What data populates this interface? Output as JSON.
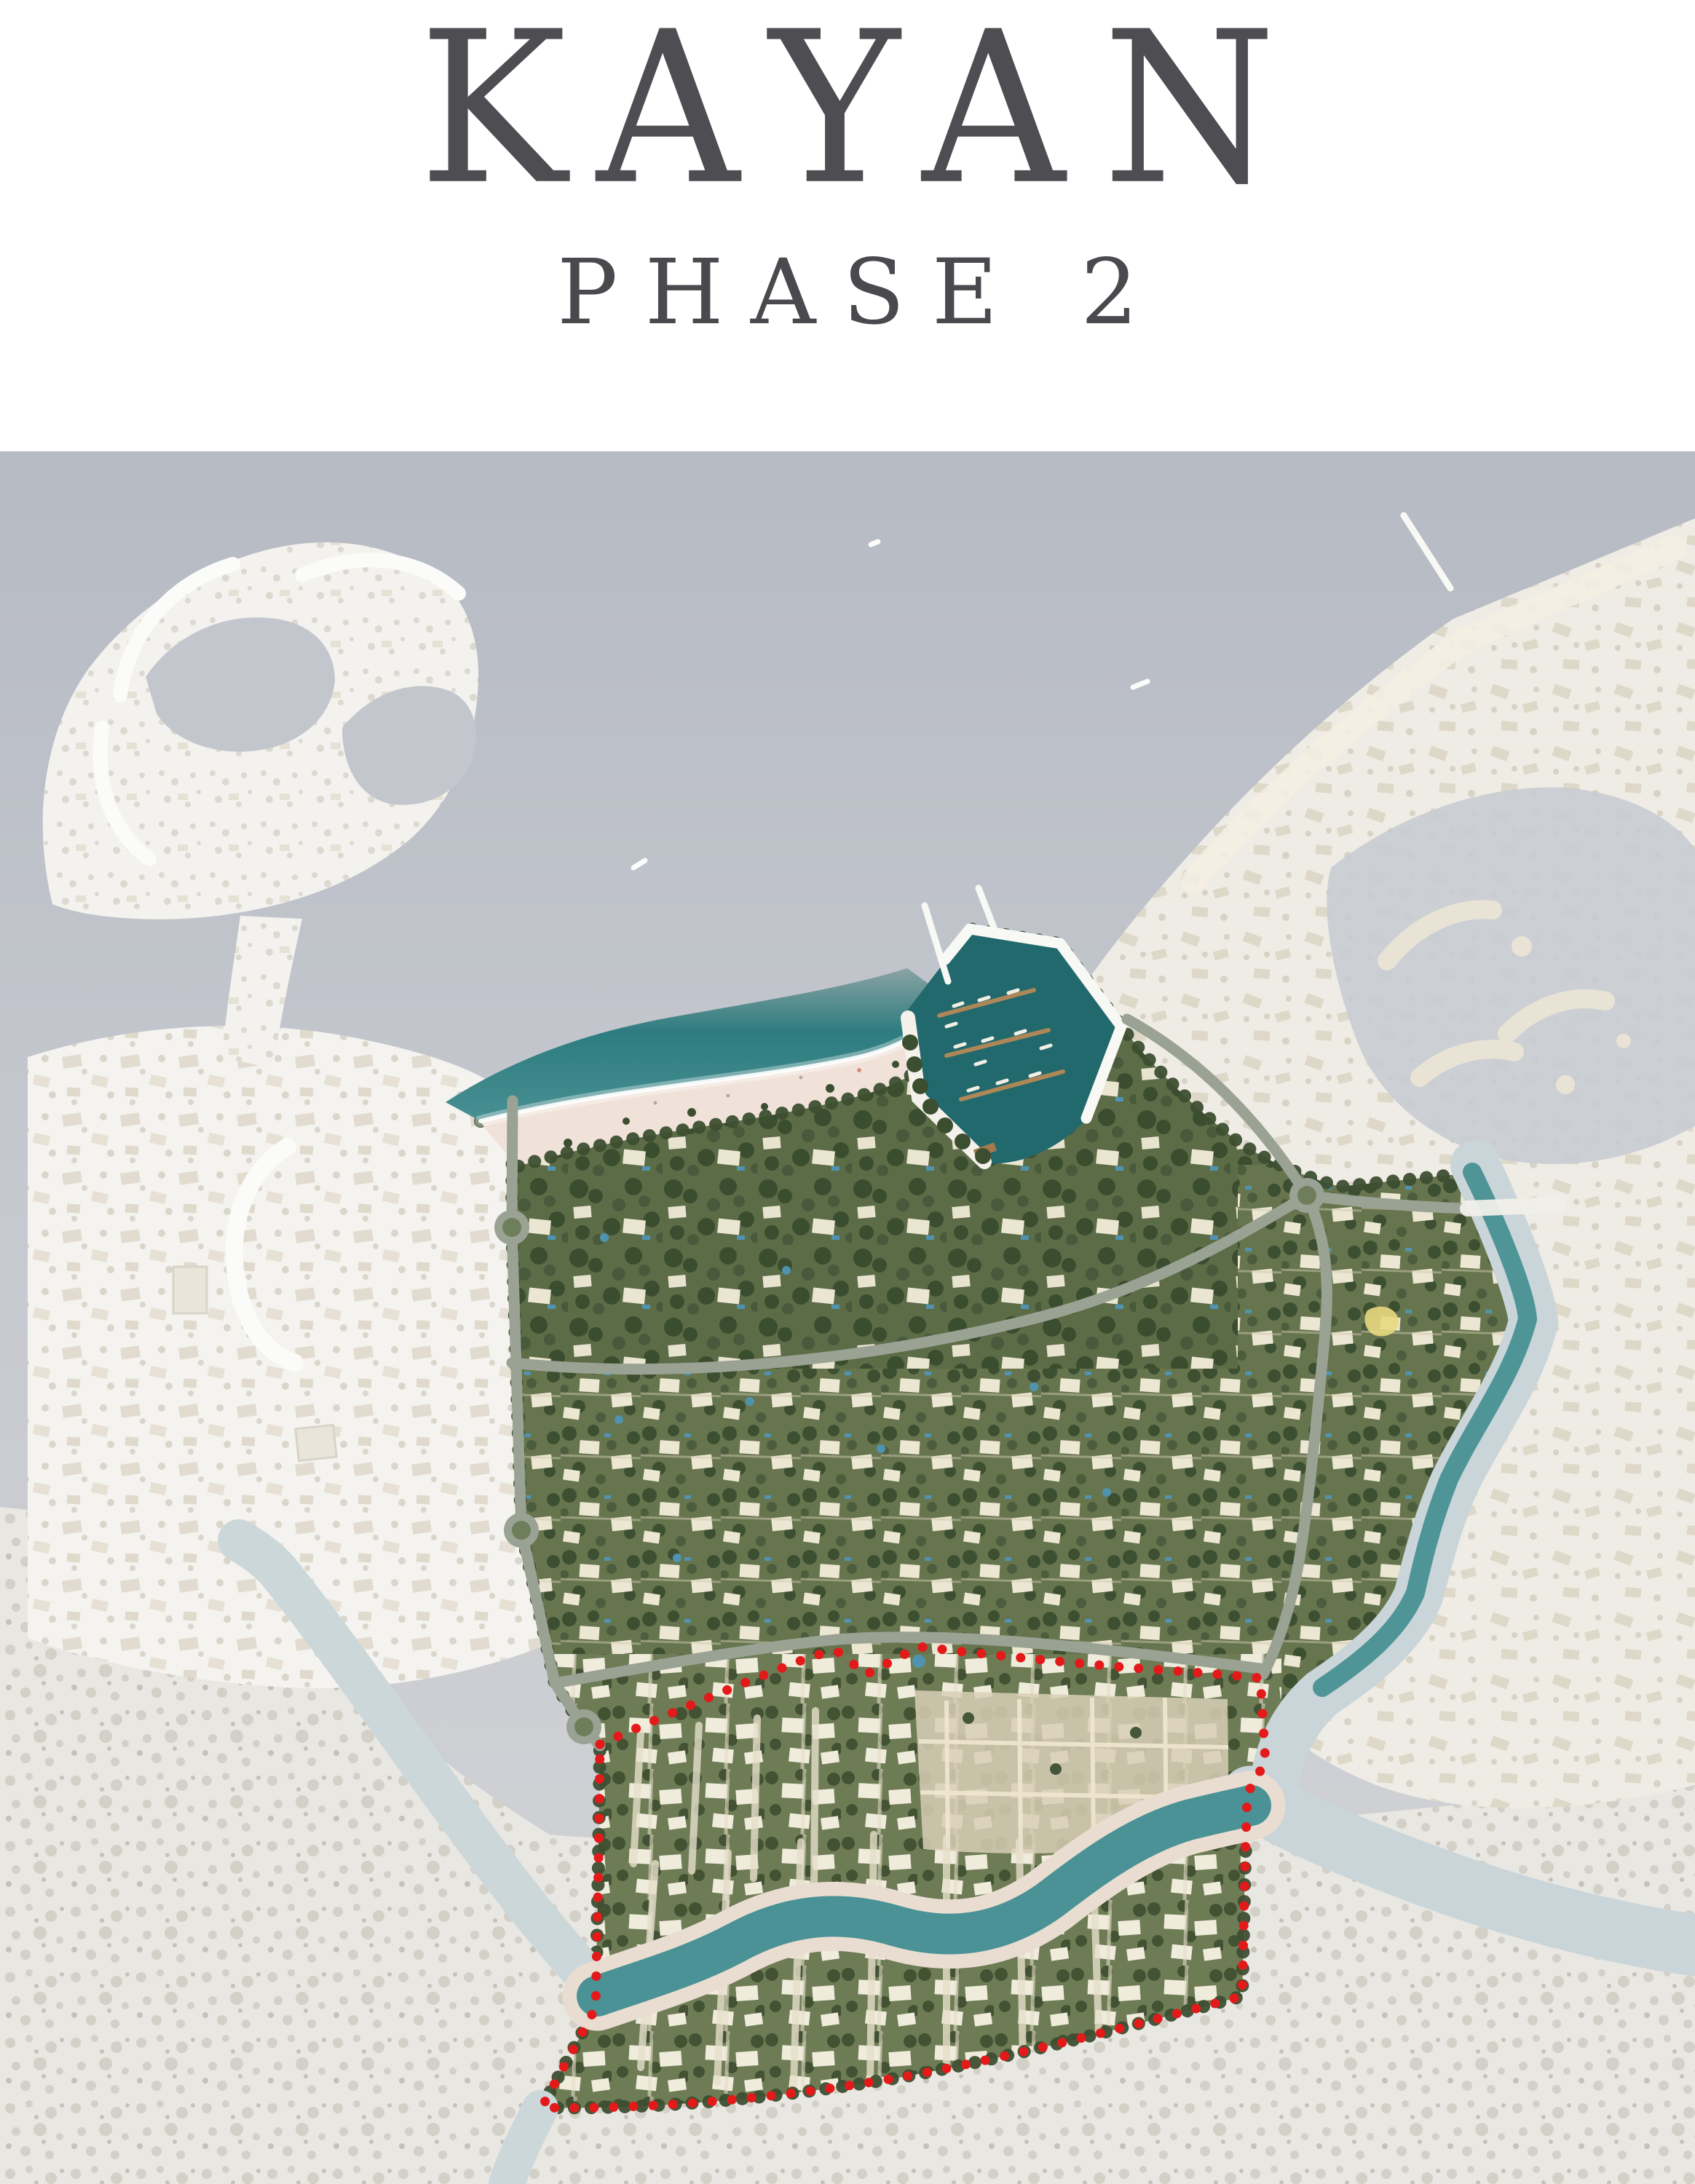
{
  "header": {
    "title": "KAYAN",
    "subtitle": "PHASE 2"
  },
  "map": {
    "type": "masterplan-aerial-rendering",
    "description": "Aerial masterplan of the Kayan coastal villa community; Phase 2 area outlined with a red dotted boundary in the southern districts around a winding waterway.",
    "regions": {
      "sea": {
        "name": "Sea",
        "color": "#bcc0c8"
      },
      "left_town": {
        "name": "Neighboring community west (faded)",
        "color": "#f4f3ef"
      },
      "crescent_community": {
        "name": "Crescent marina community north-west (faded)",
        "color": "#f3f2ee"
      },
      "right_community": {
        "name": "Neighboring lagoon community east (faded)",
        "color": "#efece5"
      },
      "outskirts": {
        "name": "Outskirts south (faded)",
        "color": "#e9e7e2"
      },
      "site": {
        "name": "Kayan villa community greenery",
        "color": "#5f6f4a"
      },
      "beach": {
        "name": "Beach",
        "color": "#f1e2d9"
      },
      "lagoon": {
        "name": "Lagoon",
        "color": "#2d7c7f"
      },
      "marina": {
        "name": "Marina basin with berthed boats",
        "color": "#21696c"
      },
      "east_canal": {
        "name": "East canal",
        "color": "#4f9598"
      },
      "river": {
        "name": "Winding waterway through Phase 2",
        "color": "#4a9295"
      },
      "phase2_boundary": {
        "name": "Phase 2 boundary",
        "color": "#e41a1a",
        "line_style": "dotted"
      }
    },
    "geometry": {
      "bottom_land": "M 0,2070 C 170,2085 310,2145 415,2245 C 515,2340 615,2435 755,2520 C 1180,2555 1760,2515 2328,2440 L 2328,3000 L 0,3000 Z",
      "left_town": "M 38,1452 C 185,1405 345,1398 485,1425 C 585,1445 655,1468 702,1505 L 702,1690 L 716,2102 L 744,2262 C 640,2302 518,2324 398,2318 C 278,2312 148,2290 38,2250 Z",
      "crescent_land": "M 72,1242 C 45,1130 58,1008 122,918 C 182,838 272,778 372,754 C 452,735 532,746 592,786 C 642,820 662,882 656,952 C 650,1032 620,1102 564,1152 C 494,1212 398,1246 298,1258 C 214,1268 120,1262 72,1242 Z",
      "connector": "M 330,1258 C 320,1330 310,1390 305,1452 L 375,1468 C 385,1400 400,1330 415,1262 Z",
      "right_dev": "M 1500,1338 C 1560,1255 1642,1160 1722,1080 C 1802,1000 1902,915 1996,850 L 2328,712 L 2328,2452 C 2168,2492 2008,2496 1890,2452 C 1814,2422 1760,2382 1734,2340 L 1734,2100 L 1500,1700 Z",
      "right_water": "M 1828,1192 C 1918,1120 2040,1076 2150,1082 C 2240,1090 2300,1126 2328,1166 L 2328,1546 C 2258,1588 2168,1608 2078,1595 C 1988,1580 1908,1525 1870,1445 C 1838,1370 1810,1256 1828,1192 Z",
      "site": "M 660,1540 C 850,1492 1030,1485 1180,1452 C 1250,1435 1285,1405 1308,1375 L 1332,1276 L 1455,1296 L 1540,1410 C 1580,1462 1640,1522 1700,1568 C 1742,1596 1790,1616 1840,1630 L 2014,1612 C 2060,1700 2094,1780 2097,1812 C 2076,1890 2024,1956 1988,2032 C 1964,2092 1953,2144 1943,2188 C 1918,2244 1865,2284 1812,2320 C 1778,2346 1755,2390 1747,2445 L 1714,2462 L 1710,2560 L 1706,2742 C 1565,2780 1405,2822 1245,2852 C 1085,2880 905,2898 744,2895 L 818,2758 L 822,2560 L 824,2396 L 800,2372 L 762,2312 L 716,2102 L 703,1686 L 704,1512 Z",
      "waterline": "M 660,1540 C 850,1492 1030,1485 1180,1452 C 1250,1435 1285,1405 1308,1375",
      "beach": "M 660,1540 C 850,1492 1030,1485 1180,1452 C 1250,1435 1285,1405 1308,1375 L 1320,1405 C 1300,1452 1252,1485 1182,1505 C 1045,1543 875,1552 712,1602 C 692,1580 672,1560 660,1540 Z",
      "beach_treeline": "M 712,1602 C 875,1552 1045,1543 1182,1505 C 1252,1485 1300,1452 1320,1405",
      "lagoon": "M 612,1514 C 698,1458 798,1420 918,1398 C 1038,1376 1150,1360 1246,1330 L 1308,1375 C 1285,1405 1250,1435 1180,1452 C 1030,1485 850,1492 660,1540 Z",
      "marina": "M 1243,1392 L 1332,1276 L 1456,1296 L 1540,1410 L 1490,1540 C 1448,1582 1398,1602 1350,1598 L 1260,1512 Z",
      "marina_pier": "M 1298,1318 L 1332,1276 L 1456,1296 L 1540,1410 L 1492,1536",
      "marina_promenade": "M 1247,1398 L 1262,1508 L 1352,1596",
      "river_path": "M 820,2742 C 890,2718 952,2700 1012,2668 C 1082,2630 1152,2622 1232,2646 C 1302,2666 1372,2660 1442,2610 C 1502,2564 1562,2520 1632,2500 C 1680,2488 1702,2484 1718,2480",
      "river_faded_west": "M 820,2730 C 762,2668 700,2590 620,2480 C 560,2400 470,2268 382,2158 C 362,2136 344,2126 328,2116",
      "river_faded_south": "M 742,2896 C 722,2936 706,2968 696,3000",
      "canal_outer": "M 2026,1600 C 2072,1698 2104,1784 2106,1816 C 2086,1896 2034,1962 1998,2036 C 1972,2096 1960,2148 1948,2192 C 1924,2248 1870,2290 1816,2326 C 1780,2358 1757,2400 1750,2452",
      "canal_teal": "M 2022,1610 C 2066,1700 2096,1780 2098,1812 C 2078,1890 2026,1956 1990,2032 C 1966,2092 1954,2144 1944,2188 C 1920,2243 1868,2283 1816,2318",
      "canal_sweep": "M 1718,2468 C 1780,2506 1880,2548 1992,2588 C 2112,2630 2230,2658 2328,2672",
      "boundary": "M 824,2396 C 905,2360 1005,2318 1082,2288 C 1122,2272 1144,2266 1152,2270 L 1190,2300 L 1262,2262 C 1350,2272 1455,2283 1555,2291 C 1625,2296 1692,2301 1731,2305 L 1738,2420 L 1713,2464 L 1710,2560 L 1706,2742 C 1565,2780 1405,2822 1245,2852 C 1085,2880 905,2898 744,2895 L 818,2758 L 822,2560 Z",
      "road_west": "M 704,1512 L 703,1686 L 716,2102 L 762,2312 L 802,2372 L 824,2398",
      "road_mid": "M 703,1872 C 950,1898 1230,1862 1440,1806 C 1580,1768 1700,1700 1795,1642",
      "road_phase2_top": "M 762,2312 C 900,2288 1040,2262 1150,2252 C 1300,2240 1500,2262 1731,2292",
      "road_east": "M 1795,1642 C 1822,1700 1826,1760 1820,1830 C 1810,1935 1800,2040 1788,2120 C 1778,2190 1760,2250 1735,2300",
      "road_ne_spur": "M 1795,1642 C 1740,1555 1660,1462 1548,1400",
      "road_ne_east": "M 1795,1642 C 1870,1652 1950,1658 2016,1660",
      "compound": "M 1256,2322 L 1686,2334 L 1688,2520 C 1560,2546 1400,2552 1268,2540 Z"
    }
  }
}
